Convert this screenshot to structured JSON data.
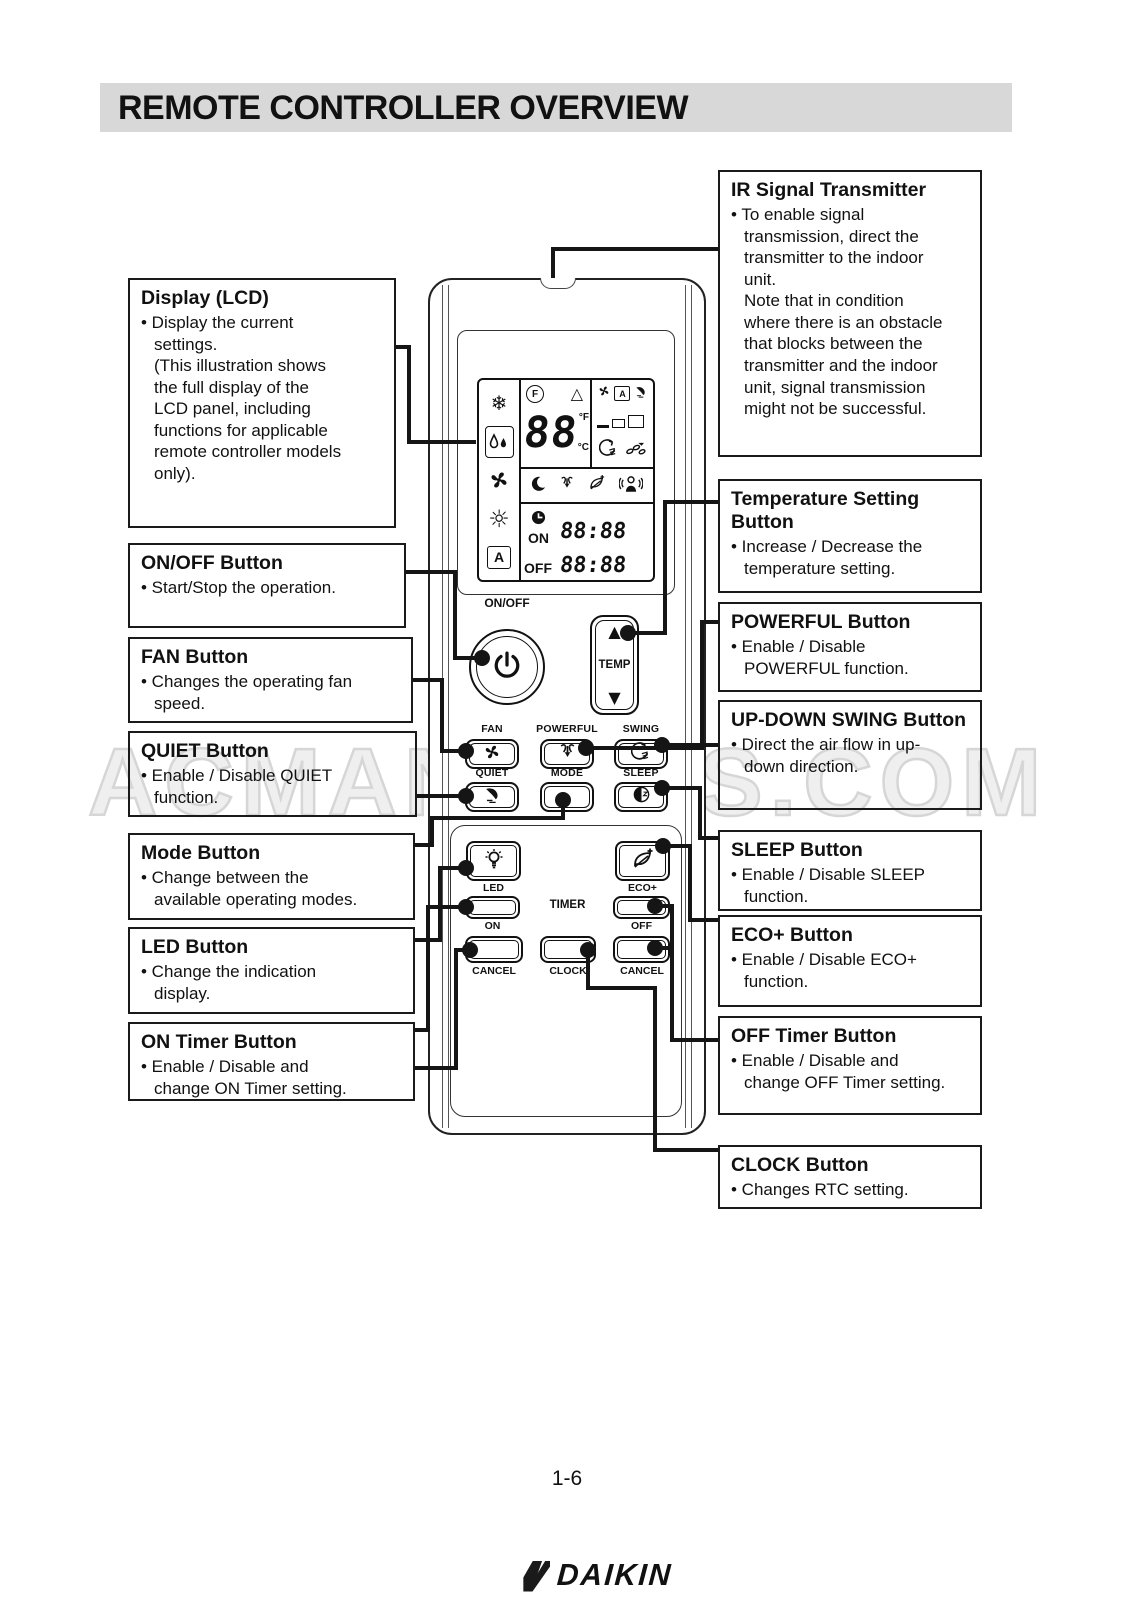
{
  "title": "REMOTE CONTROLLER OVERVIEW",
  "page_number": "1-6",
  "watermark": "ACMANUALS.COM",
  "colors": {
    "title_bar_bg": "#d8d8d8",
    "ink": "#111111",
    "watermark_gray": "#d6d6d6"
  },
  "callouts": {
    "display_lcd": {
      "title": "Display (LCD)",
      "body": "• Display the current\nsettings.\n(This illustration shows\nthe full display of the\nLCD panel, including\nfunctions for applicable\nremote controller models\nonly)."
    },
    "on_off": {
      "title": "ON/OFF Button",
      "body": "• Start/Stop the operation."
    },
    "fan": {
      "title": "FAN Button",
      "body": "• Changes the operating fan\nspeed."
    },
    "quiet": {
      "title": "QUIET Button",
      "body": "• Enable / Disable QUIET\nfunction."
    },
    "mode": {
      "title": "Mode Button",
      "body": "• Change between the\navailable operating modes."
    },
    "led": {
      "title": "LED Button",
      "body": "• Change the indication\ndisplay."
    },
    "on_timer": {
      "title": "ON Timer Button",
      "body": "• Enable / Disable and\nchange ON Timer setting."
    },
    "ir": {
      "title": "IR Signal Transmitter",
      "body": "• To enable signal\ntransmission, direct the\ntransmitter to the indoor\nunit.\nNote that in condition\nwhere there is an obstacle\nthat blocks between the\ntransmitter and the indoor\nunit, signal transmission\nmight not be successful."
    },
    "temp_setting": {
      "title": "Temperature Setting Button",
      "body": "• Increase / Decrease the\ntemperature setting."
    },
    "powerful": {
      "title": "POWERFUL Button",
      "body": "• Enable / Disable\nPOWERFUL function."
    },
    "up_down_swing": {
      "title": "UP-DOWN SWING Button",
      "body": "• Direct the air flow in up-\ndown direction."
    },
    "sleep": {
      "title": "SLEEP Button",
      "body": "• Enable / Disable SLEEP\nfunction."
    },
    "eco_plus": {
      "title": "ECO+ Button",
      "body": "• Enable / Disable ECO+\nfunction."
    },
    "off_timer": {
      "title": "OFF Timer Button",
      "body": "• Enable / Disable and\nchange OFF Timer setting."
    },
    "clock": {
      "title": "CLOCK Button",
      "body": "• Changes RTC setting."
    }
  },
  "remote": {
    "brand": "DAIKIN",
    "labels": {
      "on_off": "ON/OFF",
      "temp": "TEMP",
      "fan": "FAN",
      "powerful": "POWERFUL",
      "swing": "SWING",
      "quiet": "QUIET",
      "mode": "MODE",
      "sleep": "SLEEP",
      "led": "LED",
      "eco_plus": "ECO+",
      "timer": "TIMER",
      "timer_on": "ON",
      "timer_off": "OFF",
      "cancel_left": "CANCEL",
      "clock": "CLOCK",
      "cancel_right": "CANCEL"
    },
    "glyphs": {
      "snowflake": "❄",
      "sun": "☼",
      "tri_up": "▲",
      "tri_down": "▼",
      "delta": "△"
    },
    "lcd": {
      "f_indicator": "F",
      "temp_value": "88",
      "deg_f": "°F",
      "deg_c": "°C",
      "auto_letter": "A",
      "fan_auto_letter": "A",
      "on_label": "ON",
      "off_label": "OFF",
      "on_time": "88:88",
      "off_time": "88:88"
    }
  }
}
